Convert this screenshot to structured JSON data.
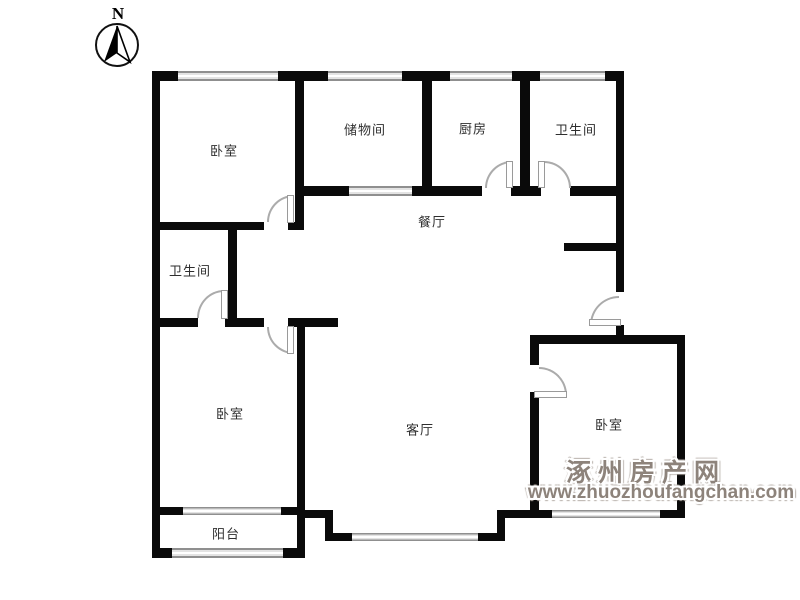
{
  "compass": {
    "label": "N"
  },
  "rooms": {
    "bedroom_top_left": {
      "label": "卧室"
    },
    "storage": {
      "label": "储物间"
    },
    "kitchen": {
      "label": "厨房"
    },
    "bathroom_top": {
      "label": "卫生间"
    },
    "dining": {
      "label": "餐厅"
    },
    "bathroom_left": {
      "label": "卫生间"
    },
    "bedroom_bottom_left": {
      "label": "卧室"
    },
    "living": {
      "label": "客厅"
    },
    "bedroom_bottom_right": {
      "label": "卧室"
    },
    "balcony": {
      "label": "阳台"
    }
  },
  "watermark": {
    "site_name": "涿州房产网",
    "url": "www.zhuozhoufangchan.com"
  },
  "colors": {
    "wall": "#0a0a0a",
    "window_gray": "#8f8f8f",
    "door_arc": "#ababab",
    "watermark": "#8d837b",
    "label_text": "#2e2e2e"
  }
}
